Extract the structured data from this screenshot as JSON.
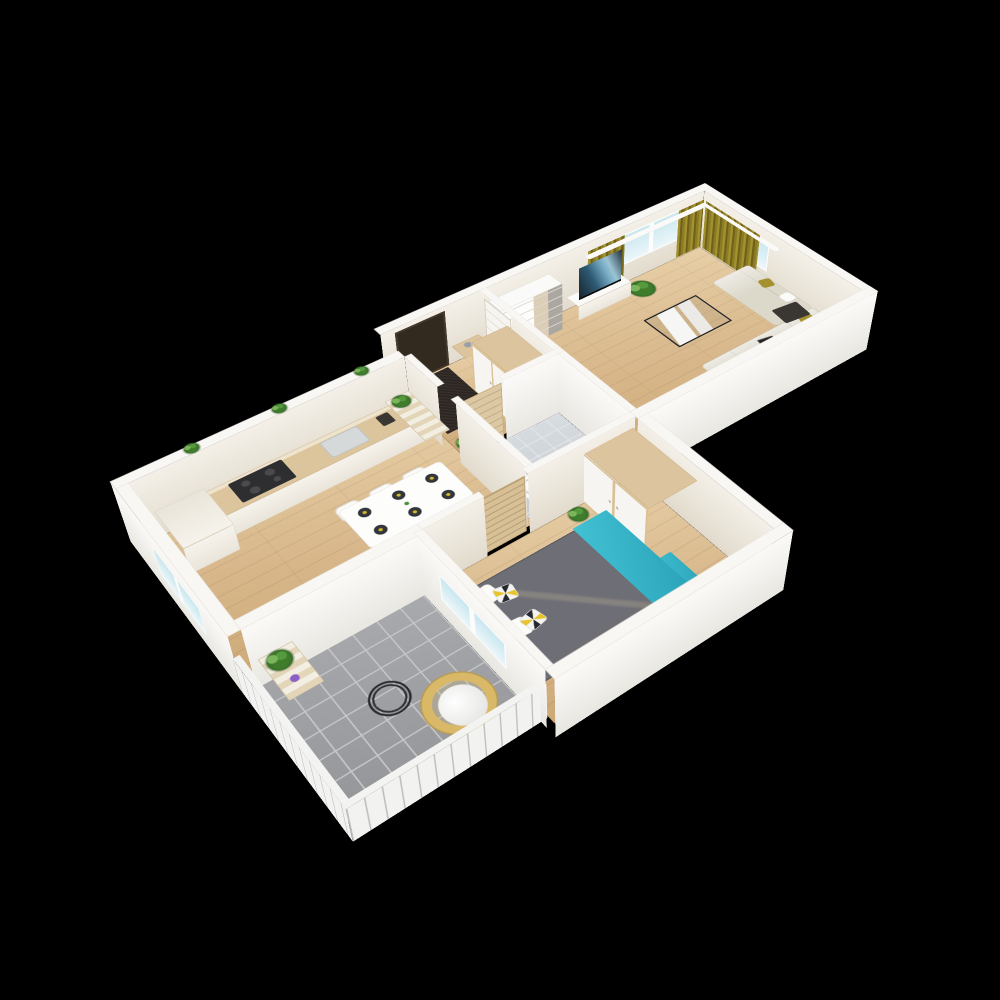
{
  "scene": {
    "background": "#000000",
    "plan_width": 1190,
    "plan_height": 730,
    "wall_h": 120,
    "rail_h": 70,
    "palette": {
      "wall_top": "#f8f7f4",
      "wall_face_light": "#f1ece3",
      "wall_face_bright": "#fbfaf8",
      "floor_wood": "#d8b88c",
      "balcony_tile": "#9b9c9f",
      "bath_tile": "#cdd3d7",
      "curtain_olive": "#8b7b24",
      "sofa_beige": "#dcd8ca",
      "accent_teal": "#35b7cb",
      "accent_yellow": "#e8d42c",
      "accent_olive": "#a5902f",
      "plant_green": "#4e8f3a",
      "window_glass": "#d4ecf2",
      "dark": "#32291f"
    },
    "rooms": [
      "kitchen-dining",
      "entry-hall",
      "bathroom",
      "living-room",
      "bedroom",
      "balcony"
    ]
  },
  "elements": [
    [
      "floor-kitchen",
      "f",
      "wood",
      18,
      88,
      464,
      312,
      0
    ],
    [
      "floor-entry",
      "f",
      "wood",
      482,
      18,
      178,
      197,
      0
    ],
    [
      "floor-bath",
      "f",
      "tile-bath",
      482,
      227,
      178,
      173,
      0
    ],
    [
      "floor-living",
      "f",
      "wood",
      672,
      18,
      478,
      382,
      0
    ],
    [
      "floor-bedroom",
      "f",
      "wood",
      290,
      412,
      370,
      288,
      0
    ],
    [
      "floor-balcony",
      "f",
      "tile-gray",
      10,
      412,
      268,
      266,
      0
    ],
    [
      "entry-rug",
      "f",
      "dark-rug",
      490,
      24,
      94,
      138,
      2
    ],
    [
      "wall-cap-top",
      "c",
      "cap",
      470,
      0,
      698,
      18
    ],
    [
      "wall-cap-right",
      "c",
      "cap",
      1150,
      18,
      18,
      400
    ],
    [
      "wall-cap-kitchen-top",
      "c",
      "cap",
      0,
      70,
      470,
      18
    ],
    [
      "wall-cap-left",
      "c",
      "cap",
      0,
      88,
      18,
      330
    ],
    [
      "wall-cap-entry-kitchen",
      "c",
      "cap",
      470,
      88,
      12,
      90
    ],
    [
      "wall-cap-bath-left",
      "c",
      "cap",
      470,
      227,
      12,
      173
    ],
    [
      "wall-cap-entry-living",
      "c",
      "cap",
      660,
      18,
      12,
      197
    ],
    [
      "wall-cap-bath-top-a",
      "c",
      "cap",
      470,
      215,
      12,
      12
    ],
    [
      "wall-cap-bath-top-b",
      "c",
      "cap",
      557,
      215,
      115,
      12
    ],
    [
      "wall-cap-bath-living",
      "c",
      "cap",
      660,
      227,
      12,
      173
    ],
    [
      "wall-cap-living-bottom",
      "c",
      "cap",
      660,
      400,
      508,
      18
    ],
    [
      "wall-cap-kitchen-balcony",
      "c",
      "cap",
      18,
      400,
      272,
      18
    ],
    [
      "wall-cap-bedroom-top-a",
      "c",
      "cap",
      290,
      400,
      100,
      12
    ],
    [
      "wall-cap-bedroom-top-b",
      "c",
      "cap",
      465,
      400,
      195,
      12
    ],
    [
      "wall-cap-bedroom-left",
      "c",
      "cap",
      278,
      412,
      12,
      288
    ],
    [
      "wall-cap-bedroom-right",
      "c",
      "cap",
      660,
      418,
      18,
      282
    ],
    [
      "wall-cap-bedroom-bottom",
      "c",
      "cap",
      278,
      700,
      400,
      18
    ],
    [
      "rail-cap-left",
      "c",
      "cap-rail",
      0,
      412,
      10,
      276,
      70
    ],
    [
      "rail-cap-bottom",
      "c",
      "cap-rail",
      0,
      678,
      288,
      10,
      70
    ],
    [
      "wall-face-top-inner",
      "x",
      "face-light",
      470,
      18,
      680,
      120
    ],
    [
      "front-door",
      "x",
      "door-dark",
      495,
      19,
      95,
      112,
      0
    ],
    [
      "window-living-top",
      "x",
      "window-pane",
      962,
      19,
      130,
      64,
      40
    ],
    [
      "curtain-left",
      "x",
      "curtain",
      880,
      23,
      82,
      100,
      6
    ],
    [
      "curtain-mid",
      "x",
      "curtain",
      1086,
      23,
      60,
      100,
      6
    ],
    [
      "curtain-right",
      "y",
      "curtain",
      1146,
      28,
      140,
      100,
      6
    ],
    [
      "curtain-rod-top",
      "c",
      "rod",
      872,
      24,
      292,
      12,
      100,
      6
    ],
    [
      "curtain-rod-side",
      "c",
      "rod",
      1138,
      30,
      12,
      185,
      100,
      6
    ],
    [
      "wall-face-right-inner",
      "y",
      "face-light",
      1150,
      18,
      400,
      120
    ],
    [
      "window-living-right",
      "y",
      "window-pane",
      1149,
      40,
      150,
      60,
      40
    ],
    [
      "wall-face-kitchen-top",
      "x",
      "face-light",
      18,
      88,
      452,
      120
    ],
    [
      "wall-face-left-outer",
      "y",
      "face-bright",
      0,
      70,
      348,
      120
    ],
    [
      "window-kitchen",
      "y",
      "window-pane",
      -1,
      190,
      140,
      56,
      36
    ],
    [
      "wall-face-entry-kitchen",
      "y",
      "face-light",
      470,
      88,
      90,
      120
    ],
    [
      "wall-face-bath-left",
      "y",
      "face-light",
      470,
      227,
      173,
      120
    ],
    [
      "wall-face-entry-living-a",
      "y",
      "face-light",
      660,
      18,
      12,
      120
    ],
    [
      "wall-face-entry-living-b",
      "y",
      "face-light",
      660,
      105,
      110,
      120
    ],
    [
      "door-living",
      "y",
      "door-white",
      659,
      30,
      75,
      112,
      0
    ],
    [
      "wall-face-bath-top",
      "x",
      "face-bright",
      557,
      227,
      115,
      120
    ],
    [
      "door-bath",
      "x",
      "door-wood",
      482,
      221,
      75,
      112,
      0
    ],
    [
      "wall-face-bath-living",
      "y",
      "face-bright",
      660,
      227,
      173,
      120
    ],
    [
      "wall-face-living-bottom",
      "x",
      "face-bright",
      660,
      418,
      508,
      120
    ],
    [
      "wall-face-kitchen-balcony",
      "x",
      "face-bright",
      18,
      418,
      272,
      120
    ],
    [
      "door-balcony",
      "x",
      "window-pane",
      200,
      417,
      75,
      110,
      4
    ],
    [
      "wall-face-bedroom-top-a",
      "x",
      "face-light",
      290,
      412,
      100,
      120
    ],
    [
      "wall-face-bedroom-top-b",
      "x",
      "face-light",
      465,
      412,
      195,
      120
    ],
    [
      "door-bedroom",
      "x",
      "door-slat",
      388,
      406,
      76,
      112,
      0
    ],
    [
      "wall-face-bedroom-left",
      "y",
      "face-bright",
      278,
      412,
      288,
      120
    ],
    [
      "window-bedroom",
      "y",
      "window-pane",
      277,
      467,
      150,
      52,
      36
    ],
    [
      "wall-face-bedroom-right",
      "y",
      "face-light",
      660,
      418,
      282,
      120
    ],
    [
      "wall-face-bedroom-bottom",
      "x",
      "face-bright",
      278,
      718,
      400,
      120
    ],
    [
      "balcony-rail-left",
      "y",
      "rail",
      0,
      412,
      276,
      70
    ],
    [
      "balcony-rail-bottom",
      "x",
      "rail",
      0,
      688,
      288,
      70
    ],
    [
      "kitchen-counter",
      "f",
      "counter-top",
      118,
      90,
      352,
      62,
      44,
      3
    ],
    [
      "kitchen-counter-front",
      "x",
      "cab-white",
      118,
      152,
      352,
      44,
      0
    ],
    [
      "kitchen-tall-cabinet",
      "f",
      "cab-white",
      40,
      90,
      78,
      92,
      52,
      2
    ],
    [
      "kitchen-tall-cabinet-front",
      "x",
      "cab-white",
      40,
      182,
      78,
      52,
      0
    ],
    [
      "cooktop",
      "f",
      "cooktop",
      150,
      98,
      88,
      48,
      46
    ],
    [
      "kitchen-sink",
      "f",
      "sink",
      300,
      102,
      66,
      42,
      46,
      6
    ],
    [
      "coffee-machine",
      "f",
      "dark-item",
      398,
      104,
      22,
      26,
      46,
      3
    ],
    [
      "ledge-plant-1",
      "f",
      "plant",
      108,
      68,
      22,
      22,
      122,
      "50%"
    ],
    [
      "ledge-plant-2",
      "f",
      "plant",
      248,
      68,
      22,
      22,
      122,
      "50%"
    ],
    [
      "ledge-plant-3",
      "f",
      "plant",
      388,
      68,
      22,
      22,
      122,
      "50%"
    ],
    [
      "step-shelf",
      "f",
      "steps",
      424,
      92,
      44,
      116,
      56,
      2
    ],
    [
      "step-shelf-plant",
      "f",
      "plant",
      428,
      96,
      30,
      30,
      60,
      "50%"
    ],
    [
      "dining-table",
      "f",
      "table-white",
      248,
      244,
      176,
      92,
      44,
      8
    ],
    [
      "dining-chair-1",
      "f",
      "chair",
      258,
      206,
      40,
      34,
      12,
      10
    ],
    [
      "dining-chair-2",
      "f",
      "chair",
      316,
      206,
      40,
      34,
      12,
      10
    ],
    [
      "dining-chair-3",
      "f",
      "chair",
      374,
      206,
      40,
      34,
      12,
      10
    ],
    [
      "dining-chair-4",
      "f",
      "chair",
      258,
      340,
      40,
      34,
      12,
      10
    ],
    [
      "dining-chair-5",
      "f",
      "chair",
      316,
      340,
      40,
      34,
      12,
      10
    ],
    [
      "dining-chair-6",
      "f",
      "chair",
      374,
      340,
      40,
      34,
      12,
      10
    ],
    [
      "sideboard",
      "f",
      "sideboard",
      230,
      362,
      232,
      36,
      36,
      2
    ],
    [
      "sideboard-front",
      "x",
      "cab-white",
      230,
      398,
      232,
      36,
      0
    ],
    [
      "vase-yellow",
      "f",
      "yellow-dot",
      248,
      368,
      16,
      16,
      38,
      "50%"
    ],
    [
      "jar-white",
      "f",
      "white-dot",
      286,
      370,
      12,
      12,
      38,
      "50%"
    ],
    [
      "espresso-maker",
      "f",
      "dark-item",
      330,
      366,
      22,
      26,
      38,
      3
    ],
    [
      "cup-yellow",
      "f",
      "yellow-dot",
      404,
      372,
      11,
      11,
      38,
      "50%"
    ],
    [
      "bottle-white",
      "f",
      "white-dot",
      436,
      366,
      10,
      14,
      38,
      "40%"
    ],
    [
      "console-table",
      "f",
      "wood-item",
      594,
      24,
      54,
      40,
      40,
      2
    ],
    [
      "console-vase",
      "f",
      "gray-dot",
      610,
      32,
      14,
      14,
      42,
      "50%"
    ],
    [
      "entry-wardrobe-top",
      "f",
      "wood-item",
      585,
      100,
      70,
      112,
      100,
      2
    ],
    [
      "entry-wardrobe-front",
      "y",
      "wardrobe-front",
      584,
      100,
      112,
      100,
      0
    ],
    [
      "entry-palm",
      "f",
      "plant",
      486,
      180,
      34,
      34,
      2,
      "50%"
    ],
    [
      "bathtub",
      "f",
      "tub",
      492,
      332,
      162,
      62,
      22,
      10
    ],
    [
      "toilet-tank",
      "f",
      "white-item",
      484,
      236,
      34,
      22,
      12,
      2
    ],
    [
      "toilet-bowl",
      "f",
      "white-item",
      489,
      258,
      24,
      30,
      12,
      "50%"
    ],
    [
      "bath-cabinet",
      "f",
      "white-item",
      484,
      292,
      44,
      36,
      12,
      3
    ],
    [
      "toiletry-1",
      "f",
      "dark-item",
      596,
      336,
      6,
      6,
      26,
      "50%"
    ],
    [
      "toiletry-2",
      "f",
      "dark-item",
      606,
      339,
      6,
      6,
      26,
      "50%"
    ],
    [
      "desk",
      "f",
      "white-item",
      674,
      230,
      38,
      104,
      40,
      3
    ],
    [
      "desk-chair",
      "f",
      "chair",
      714,
      256,
      40,
      42,
      14,
      12
    ],
    [
      "desk-plant",
      "f",
      "plant",
      678,
      238,
      26,
      26,
      44,
      "50%"
    ],
    [
      "bookshelf-top",
      "f",
      "white-item",
      672,
      22,
      126,
      36,
      95,
      2
    ],
    [
      "bookshelf-front",
      "x",
      "shelf-front",
      672,
      58,
      126,
      95,
      0
    ],
    [
      "tv-bench",
      "f",
      "white-item",
      834,
      22,
      118,
      34,
      30,
      2
    ],
    [
      "tv-bench-front",
      "x",
      "cab-white",
      834,
      56,
      118,
      30,
      0
    ],
    [
      "tv",
      "x",
      "tv",
      846,
      42,
      94,
      66,
      30
    ],
    [
      "corner-plant",
      "f",
      "plant-big",
      956,
      30,
      48,
      48,
      2,
      "50%"
    ],
    [
      "sofa-seat",
      "f",
      "sofa",
      888,
      308,
      258,
      88,
      34,
      8
    ],
    [
      "sofa-chaise",
      "f",
      "sofa",
      1058,
      148,
      88,
      160,
      34,
      8
    ],
    [
      "pillow-olive-1",
      "f",
      "olive-dot",
      1096,
      318,
      26,
      26,
      38,
      6,
      20
    ],
    [
      "pillow-white-1",
      "f",
      "white-dot",
      1056,
      330,
      26,
      26,
      38,
      6,
      -10
    ],
    [
      "pillow-olive-2",
      "f",
      "olive-dot",
      1116,
      200,
      24,
      24,
      38,
      6,
      15
    ],
    [
      "pillow-white-2",
      "f",
      "white-dot",
      1116,
      252,
      24,
      24,
      38,
      6,
      0
    ],
    [
      "sofa-throw",
      "f",
      "dark-item",
      1076,
      278,
      52,
      42,
      38,
      4,
      8
    ],
    [
      "tablet",
      "f",
      "tablet",
      1000,
      322,
      30,
      22,
      38,
      2,
      12
    ],
    [
      "coffee-table",
      "f",
      "c-table",
      884,
      168,
      118,
      92,
      44,
      2
    ],
    [
      "floor-lamp",
      "f",
      "dark-item",
      852,
      318,
      12,
      12,
      2,
      "50%"
    ],
    [
      "accent-chair",
      "f",
      "olive-chair",
      788,
      330,
      62,
      62,
      14,
      14
    ],
    [
      "living-plant",
      "f",
      "plant",
      692,
      358,
      34,
      34,
      2,
      "50%"
    ],
    [
      "bed-frame",
      "f",
      "bed-frame",
      296,
      464,
      266,
      190,
      22,
      4
    ],
    [
      "bed-duvet",
      "f",
      "duvet",
      304,
      470,
      212,
      178,
      30,
      6
    ],
    [
      "bed-teal",
      "f",
      "teal",
      500,
      468,
      62,
      184,
      32,
      2
    ],
    [
      "bed-teal-drape",
      "f",
      "teal",
      548,
      574,
      46,
      78,
      12,
      2
    ],
    [
      "bed-pillow-1",
      "f",
      "white-dot",
      310,
      482,
      36,
      32,
      36,
      8,
      -8
    ],
    [
      "bed-pillow-2",
      "f",
      "white-dot",
      310,
      554,
      36,
      32,
      36,
      8,
      6
    ],
    [
      "bed-pillow-tri-1",
      "f",
      "pillow-tri",
      336,
      498,
      30,
      28,
      38,
      6,
      10
    ],
    [
      "bed-pillow-tri-2",
      "f",
      "pillow-tri",
      338,
      558,
      30,
      28,
      38,
      6,
      -12
    ],
    [
      "bedroom-radiator",
      "f",
      "radiator",
      292,
      478,
      14,
      88,
      8,
      2
    ],
    [
      "bedroom-wardrobe-top",
      "f",
      "wood-item",
      566,
      406,
      90,
      148,
      100,
      2
    ],
    [
      "bedroom-wardrobe-front",
      "y",
      "wardrobe-front",
      565,
      406,
      148,
      100,
      0
    ],
    [
      "bedroom-plant",
      "f",
      "plant",
      528,
      412,
      30,
      30,
      2,
      "50%"
    ],
    [
      "balcony-shelf",
      "f",
      "steps",
      28,
      420,
      50,
      82,
      54,
      2
    ],
    [
      "balcony-plant",
      "f",
      "plant",
      32,
      424,
      34,
      34,
      58,
      "50%"
    ],
    [
      "balcony-candle",
      "f",
      "purple-dot",
      44,
      472,
      12,
      12,
      58,
      "50%"
    ],
    [
      "wire-table",
      "f",
      "wire-table",
      116,
      514,
      56,
      56,
      6,
      "50%"
    ],
    [
      "round-chair-ring",
      "f",
      "ring-chair",
      162,
      556,
      96,
      96,
      8,
      "50%"
    ],
    [
      "round-chair-cushion",
      "f",
      "cushion",
      180,
      578,
      62,
      66,
      10,
      "50%"
    ]
  ]
}
